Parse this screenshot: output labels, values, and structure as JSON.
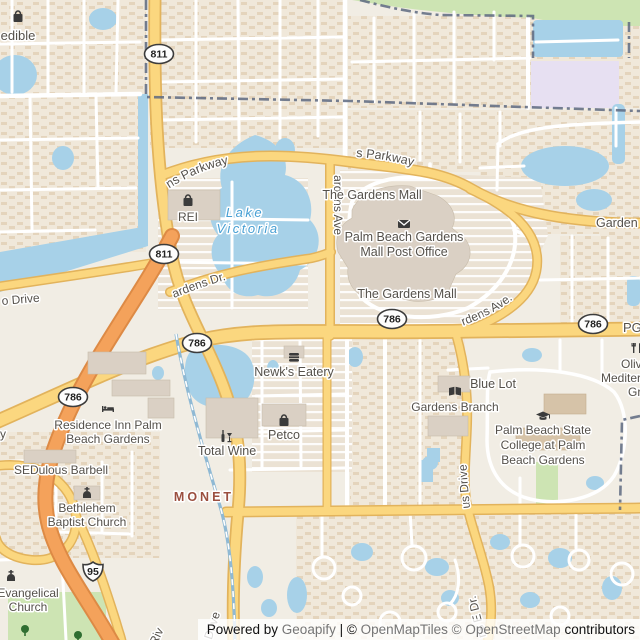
{
  "shields": {
    "alt_a1a": "811",
    "pga_blvd": "786",
    "interstate": "95"
  },
  "road_labels": {
    "gardens_parkway_west": "Gardens Parkway",
    "gardens_parkway_east": "Gardens Parkway",
    "gardens_parkway_cut": "Garden",
    "kyoto_gardens_dr": "Kyoto Gardens Dr.",
    "fairchild_gardens_ave": "Fairchild Gardens Ave",
    "kew_gardens_ave": "Kew Gardens Ave.",
    "campus_drive": "Campus Drive",
    "gardens_e_dr": "Gardens E Dr.",
    "park_drive": "Park Drive",
    "riv_cut": "Riv",
    "o_drive_cut": "o Drive",
    "y_cut": "y",
    "pga_cut": "PG"
  },
  "water_labels": {
    "lake_line1": "Lake",
    "lake_line2": "Victoria"
  },
  "neighborhood_label": "MONET",
  "pois": {
    "edible": "edible",
    "rei": "REI",
    "gardens_mall_north": "The Gardens Mall",
    "post_office_line1": "Palm Beach Gardens",
    "post_office_line2": "Mall Post Office",
    "gardens_mall_south": "The Gardens Mall",
    "newks": "Newk's Eatery",
    "petco": "Petco",
    "total_wine": "Total Wine",
    "residence_inn_line1": "Residence Inn Palm",
    "residence_inn_line2": "Beach Gardens",
    "sedulous": "SEDulous Barbell",
    "bethlehem_line1": "Bethlehem",
    "bethlehem_line2": "Baptist Church",
    "evangelical_line1": "Evangelical",
    "evangelical_line2": "Church",
    "gardens_branch": "Gardens Branch",
    "blue_lot": "Blue Lot",
    "college_line1": "Palm Beach State",
    "college_line2": "College at Palm",
    "college_line3": "Beach Gardens",
    "olive_line1": "Oliv",
    "olive_line2": "Mediter",
    "olive_line3": "Gr"
  },
  "attribution": {
    "powered_by": "Powered by",
    "geoapify": "Geoapify",
    "separator": "| ©",
    "openmaptiles": "OpenMapTiles",
    "copy2": "©",
    "openstreetmap": "OpenStreetMap",
    "contributors": "contributors"
  },
  "colors": {
    "water": "#a7d1e8",
    "water_label": "#469fd4",
    "road_yellow": "#fbd77f",
    "road_casing": "#e2b35c",
    "motorway": "#f4a25b",
    "motorway_casing": "#dd8a45",
    "green": "#cde4b3",
    "school": "#e7e0f2",
    "residential": "#f0e8da",
    "parking": "#ebe2d4",
    "boundary": "#5d6880",
    "label": "#55514b",
    "neighborhood": "#9b4f3f",
    "rail": "#8fb9d4",
    "building": "#dad0c4",
    "land": "#f1ede4"
  }
}
